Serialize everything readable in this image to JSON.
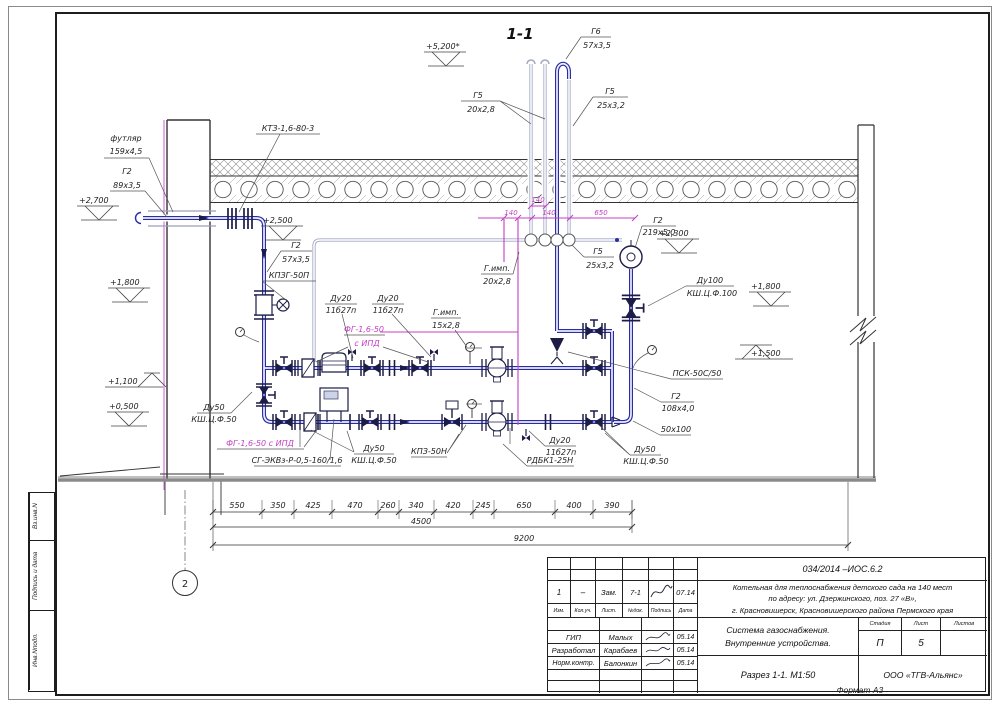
{
  "drawing": {
    "section_title": "1-1",
    "elevations": {
      "e5200": "+5,200*",
      "e2700": "+2,700",
      "e2500": "+2,500",
      "e2300": "+2,300",
      "e1800l": "+1,800",
      "e1800r": "+1,800",
      "e1500": "+1,500",
      "e1100": "+1,100",
      "e0500": "+0,500"
    },
    "labels": {
      "futlyar": {
        "l1": "футляр",
        "l2": "159x4,5"
      },
      "ktz": {
        "l1": "КТЗ-1,6-80-3"
      },
      "g2_89": {
        "l1": "Г2",
        "l2": "89x3,5"
      },
      "g5_20": {
        "l1": "Г5",
        "l2": "20x2,8"
      },
      "g6_57": {
        "l1": "Г6",
        "l2": "57x3,5"
      },
      "g5_25_top": {
        "l1": "Г5",
        "l2": "25x3,2"
      },
      "g2_57": {
        "l1": "Г2",
        "l2": "57x3,5"
      },
      "kpzg": {
        "l1": "КПЗГ-50П"
      },
      "du20_a": {
        "l1": "Ду20",
        "l2": "11б27п"
      },
      "du20_b": {
        "l1": "Ду20",
        "l2": "11б27п"
      },
      "fg_top": {
        "l1": "ФГ-1,6-50",
        "l2": "с ИПД"
      },
      "gimp15": {
        "l1": "Г.имп.",
        "l2": "15x2,8"
      },
      "gimp20": {
        "l1": "Г.имп.",
        "l2": "20x2,8"
      },
      "g5_25_mid": {
        "l1": "Г5",
        "l2": "25x3,2"
      },
      "g2_219": {
        "l1": "Г2",
        "l2": "219x5,0"
      },
      "du100": {
        "l1": "Ду100",
        "l2": "КШ.Ц.Ф.100"
      },
      "psk": {
        "l1": "ПСК-50С/50"
      },
      "g2_108": {
        "l1": "Г2",
        "l2": "108x4,0"
      },
      "red": {
        "l1": "50x100"
      },
      "du50_r": {
        "l1": "Ду50",
        "l2": "КШ.Ц.Ф.50"
      },
      "du20_c": {
        "l1": "Ду20",
        "l2": "11б27п"
      },
      "rdbk": {
        "l1": "РДБК1-25Н"
      },
      "kpz": {
        "l1": "КПЗ-50Н"
      },
      "du50_m": {
        "l1": "Ду50",
        "l2": "КШ.Ц.Ф.50"
      },
      "sg": {
        "l1": "СГ-ЭКВз-Р-0,5-160/1,6"
      },
      "fg_bot": {
        "l1": "ФГ-1,6-50 с ИПД"
      },
      "du50_l": {
        "l1": "Ду50",
        "l2": "КШ.Ц.Ф.50"
      }
    },
    "axis": "2",
    "colors": {
      "pipe": "#2a2ba6",
      "impulse": "#c43fc4",
      "construction": "#8a8a8a"
    }
  },
  "dimensions": {
    "chain": [
      "550",
      "350",
      "425",
      "470",
      "260",
      "340",
      "420",
      "245",
      "650",
      "400",
      "390"
    ],
    "subtotal": "4500",
    "total": "9200",
    "magenta": {
      "top": "140",
      "a": "140",
      "b": "140",
      "c": "650"
    }
  },
  "titleblock": {
    "doc_number": "034/2014 –ИОС.6.2",
    "project_line1": "Котельная для теплоснабжения детского сада на 140 мест",
    "project_line2": "по адресу: ул. Дзержинского, поз. 27 «В»,",
    "project_line3": "г. Красновишерск, Красновишерского района Пермского края",
    "system_line1": "Система газоснабжения.",
    "system_line2": "Внутренние устройства.",
    "view_title": "Разрез 1-1. М1:50",
    "company": "ООО «ТГВ-Альянс»",
    "stage_header": "Стадия",
    "sheet_header": "Лист",
    "sheets_header": "Листов",
    "stage": "П",
    "sheet": "5",
    "sheets": "",
    "rev_headers": [
      "Изм.",
      "Кол.уч.",
      "Лист.",
      "№док.",
      "Подпись",
      "Дата"
    ],
    "rev_row": {
      "num": "1",
      "col": "–",
      "type": "Зам.",
      "doc": "7-1",
      "date": "07.14"
    },
    "roles": [
      {
        "role": "ГИП",
        "name": "Малых",
        "date": "05.14"
      },
      {
        "role": "Разработал",
        "name": "Карабаев",
        "date": "05.14"
      },
      {
        "role": "Норм.контр.",
        "name": "Балонкин",
        "date": "05.14"
      }
    ]
  },
  "strip": {
    "c1": "Вз.инв.N",
    "c2": "Подпись и дата",
    "c3": "Инв.Nподл."
  },
  "format_note": "Формат А3"
}
